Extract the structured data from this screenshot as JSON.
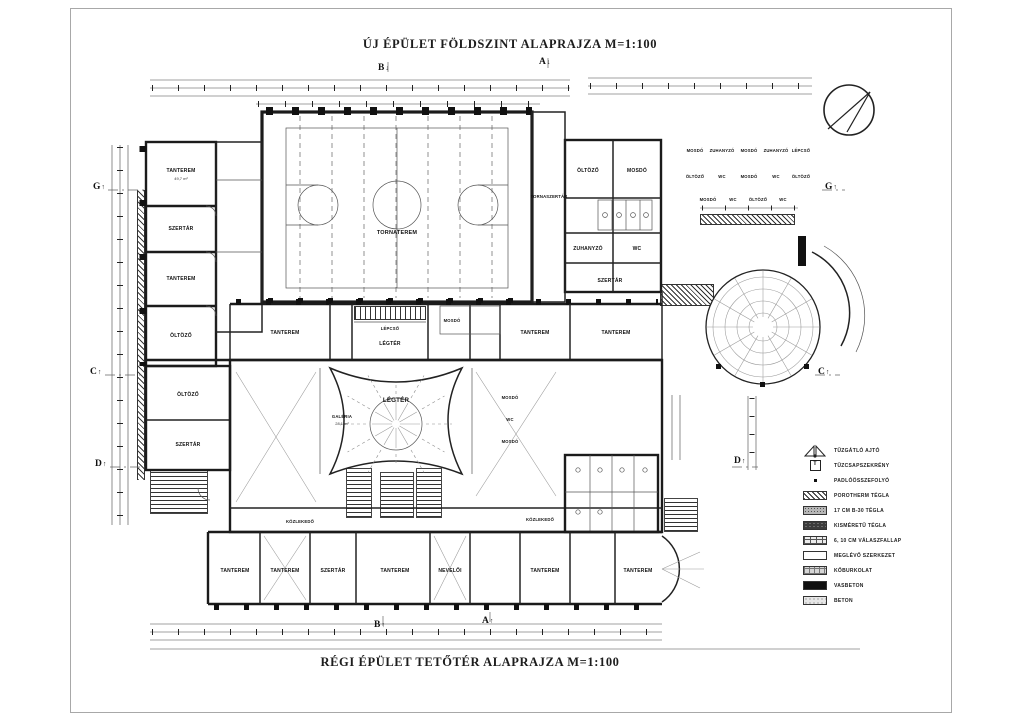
{
  "titles": {
    "top": "ÚJ ÉPÜLET FÖLDSZINT ALAPRAJZA  M=1:100",
    "bottom": "RÉGI ÉPÜLET TETŐTÉR ALAPRAJZA  M=1:100"
  },
  "legend": {
    "items": [
      {
        "symbol": "fire-door",
        "label": "TŰZGÁTLÓ AJTÓ"
      },
      {
        "symbol": "fire-hydrant-cabinet",
        "label": "TŰZCSAPSZEKRÉNY"
      },
      {
        "symbol": "floor-drain",
        "label": "PADLÓÖSSZEFOLYÓ"
      },
      {
        "symbol": "porotherm-brick",
        "label": "POROTHERM TÉGLA"
      },
      {
        "symbol": "b30-brick",
        "label": "17 CM B-30 TÉGLA"
      },
      {
        "symbol": "small-brick",
        "label": "KISMÉRETŰ TÉGLA"
      },
      {
        "symbol": "partition-panel",
        "label": "6, 10 CM VÁLASZFALLAP"
      },
      {
        "symbol": "existing-structure",
        "label": "MEGLÉVŐ SZERKEZET"
      },
      {
        "symbol": "stone-paving",
        "label": "KŐBURKOLAT"
      },
      {
        "symbol": "reinforced-concrete",
        "label": "VASBETON"
      },
      {
        "symbol": "concrete",
        "label": "BETON"
      }
    ],
    "hydrant_letter": "T"
  },
  "markers": {
    "a": "A",
    "b": "B",
    "c": "C",
    "d": "D",
    "g": "G"
  },
  "rooms": {
    "gym": "TORNATEREM",
    "gym_annex": "TORNASZERTÁR",
    "stair": "LÉPCSŐ",
    "void_upper": "LÉGTÉR",
    "void_lower": "LÉGTÉR",
    "gallery": "GALÉRIA",
    "gallery_area": "28,1 m²",
    "west": [
      "TANTEREM",
      "SZERTÁR",
      "TANTEREM",
      "ÖLTÖZŐ",
      "ÖLTÖZŐ",
      "SZERTÁR"
    ],
    "west_area": "49,7 m²",
    "east": [
      "ÖLTÖZŐ",
      "MOSDÓ",
      "ZUHANYZÓ",
      "WC",
      "SZERTÁR"
    ],
    "services": [
      [
        "MOSDÓ",
        "ZUHANYZÓ",
        "MOSDÓ",
        "ZUHANYZÓ",
        "LÉPCSŐ"
      ],
      [
        "ÖLTÖZŐ",
        "WC",
        "MOSDÓ",
        "WC",
        "ÖLTÖZŐ"
      ],
      [
        "MOSDÓ",
        "WC",
        "ÖLTÖZŐ",
        "WC"
      ]
    ],
    "mid": [
      "TANTEREM",
      "MOSDÓ",
      "TANTEREM",
      "TANTEREM"
    ],
    "atrium_east": [
      "MOSDÓ",
      "WC",
      "MOSDÓ"
    ],
    "south": [
      "TANTEREM",
      "TANTEREM",
      "SZERTÁR",
      "TANTEREM",
      "NEVELŐI",
      "TANTEREM",
      "TANTEREM"
    ],
    "corridor": "KÖZLEKEDŐ"
  }
}
